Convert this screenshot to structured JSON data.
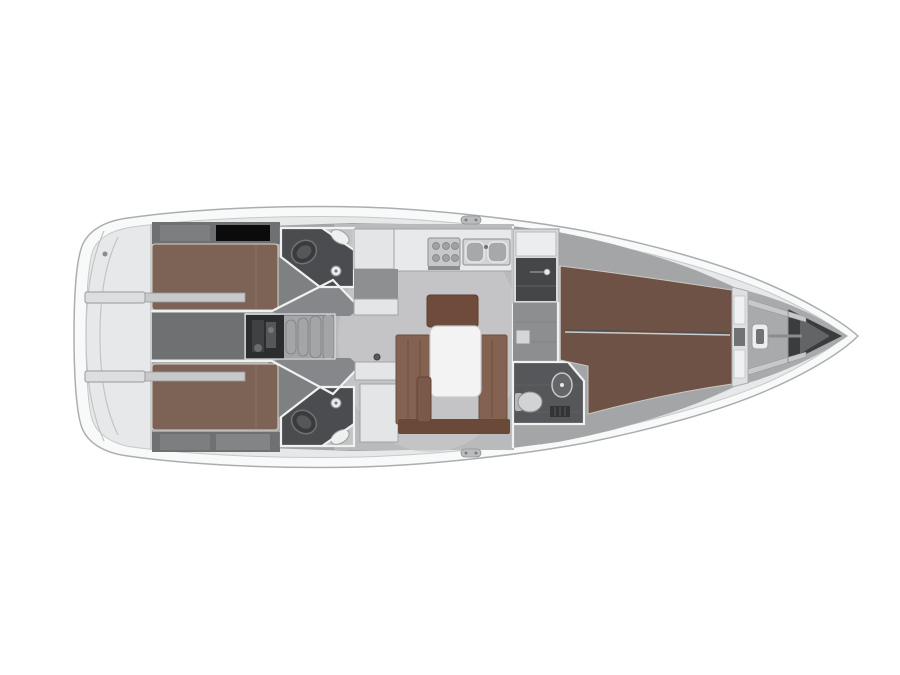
{
  "figure": {
    "kind": "sailing-yacht-interior-floor-plan",
    "view": "top-down",
    "bow_direction": "right",
    "background": "#ffffff"
  },
  "colors": {
    "bg": "#ffffff",
    "hull_fill": "#f8f9f9",
    "deck_fill": "#e7e8e9",
    "interior_base": "#a4a5a7",
    "salon_floor": "#b9babc",
    "salon_light": "#c9cacc",
    "corridor_floor": "#6f7072",
    "passage_floor": "#7e8082",
    "funnel_floor": "#85878a",
    "dark_band": "#6e7072",
    "berth_aft": "#7d6356",
    "berth_fwd": "#6d5245",
    "settee": "#846251",
    "settee_dark": "#6f4b3b",
    "bench_front": "#6b4939",
    "stool": "#7a584a",
    "table_white": "#f3f3f3",
    "counter_white": "#e8e9ea",
    "cabinet_white": "#e4e5e7",
    "head_floor": "#4a4c4f",
    "engine_dark": "#2c2d2f",
    "steps_gray": "#a3a5a7",
    "fixture_light": "#d2d3d5",
    "wardrobe_dark": "#454648",
    "anchor_dark": "#3b3c3e",
    "bow_deck": "#a8aaac",
    "step_bar": "#dddedf",
    "gap_gray": "#8d8f91",
    "corridor_fwd": "#8c8e90"
  },
  "parts": [
    "stern-swim-platform",
    "aft-cabin-port",
    "aft-cabin-starboard",
    "aft-head-port",
    "aft-head-starboard",
    "companionway-steps",
    "engine-compartment",
    "salon-settee",
    "salon-table",
    "galley",
    "wardrobe",
    "fwd-corridor",
    "fwd-head",
    "fwd-cabin-v-berth",
    "anchor-locker",
    "windlass"
  ]
}
